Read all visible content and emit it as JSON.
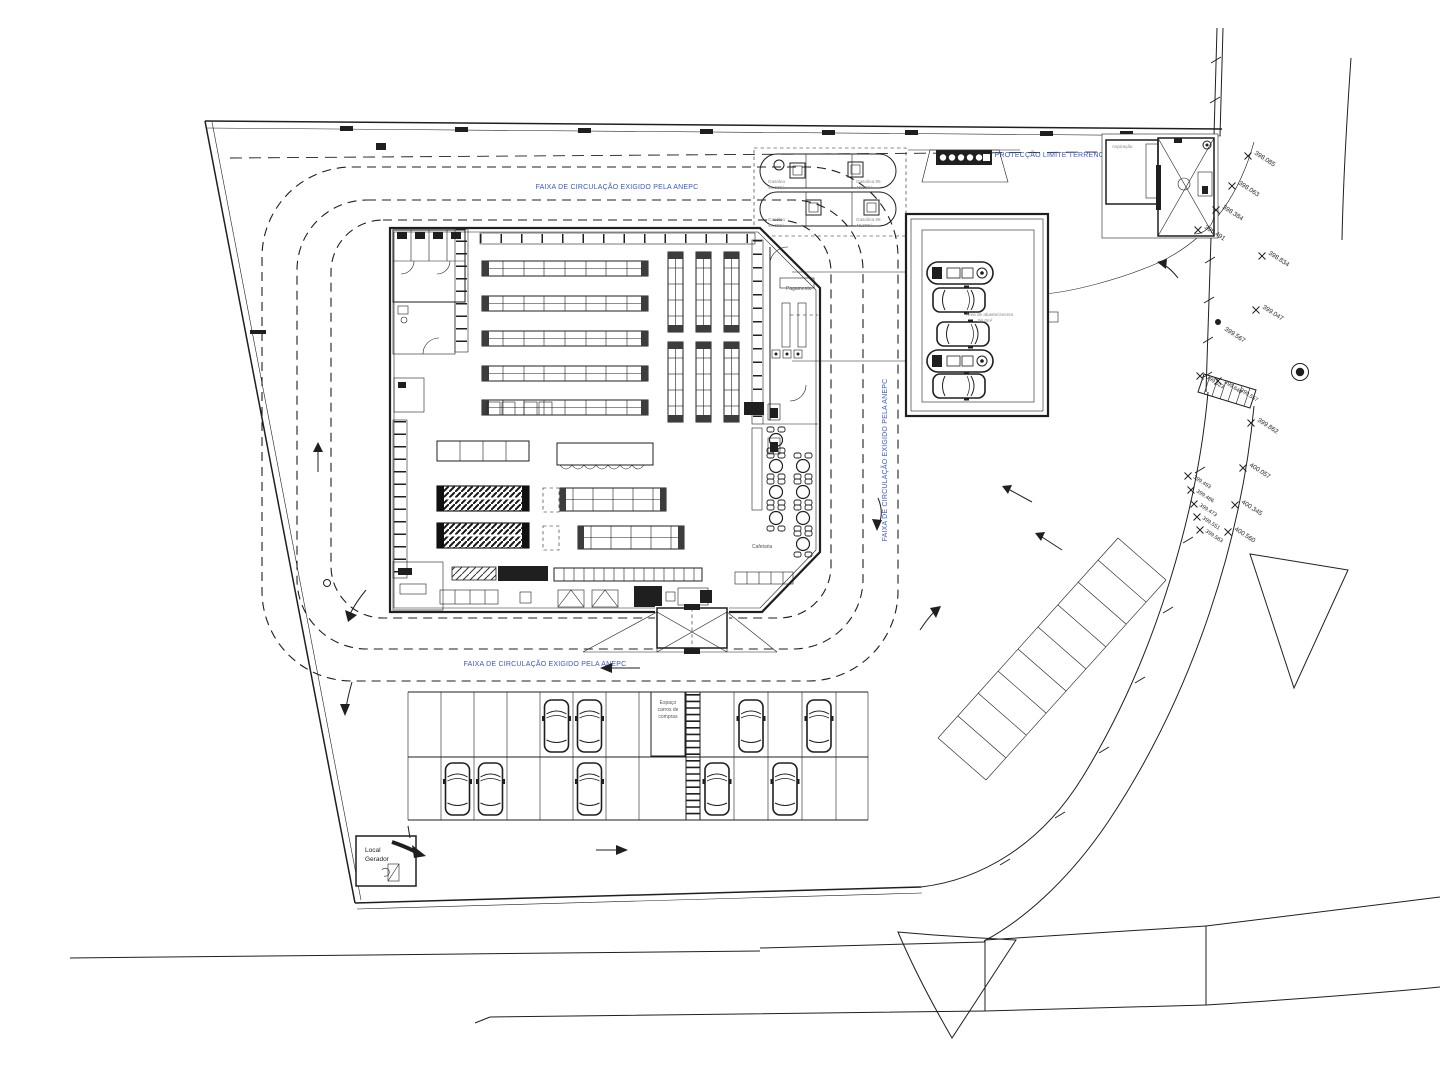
{
  "colors": {
    "ink": "#1f1f1f",
    "blue": "#3a57c5",
    "gray": "#8f8f8f",
    "paper": "#ffffff"
  },
  "annotations": {
    "protection_strip": "FAIXA DE PROTECÇÃO LIMITE TERRENO (2 metros)",
    "circulation_top": "FAIXA DE CIRCULAÇÃO EXIGIDO PELA ANEPC",
    "circulation_bottom": "FAIXA DE CIRCULAÇÃO EXIGIDO PELA ANEPC",
    "circulation_right": "FAIXA DE CIRCULAÇÃO EXIGIDO PELA ANEPC"
  },
  "building": {
    "pagamento_label": "Pagamento",
    "cafetaria_label": "Cafetaria"
  },
  "fuel_station": {
    "kiosk_label": "Aspiração",
    "area_label_l1": "Área de abastecimento",
    "area_label_l2": "56.0m²",
    "tank1_left_l1": "Gasóleo",
    "tank1_left_l2": "40.000 l",
    "tank1_right_l1": "Gasolina 95",
    "tank1_right_l2": "40.000 l",
    "tank2_left_l1": "Gasóleo",
    "tank2_left_l2": "40.000 l",
    "tank2_right_l1": "Gasolina 98",
    "tank2_right_l2": "40.000 l"
  },
  "parking": {
    "cart_area_l1": "Espaço",
    "cart_area_l2": "carros de",
    "cart_area_l3": "compras"
  },
  "generator": {
    "label_l1": "Local",
    "label_l2": "Gerador"
  },
  "elevations": [
    "398.085",
    "398.063",
    "398.384",
    "398.491",
    "398.834",
    "399.047",
    "399.567",
    "399.523",
    "399.640",
    "399.557",
    "399.862",
    "400.057",
    "400.345",
    "400.560",
    "399.493",
    "399.486",
    "399.473",
    "399.551",
    "399.563"
  ]
}
